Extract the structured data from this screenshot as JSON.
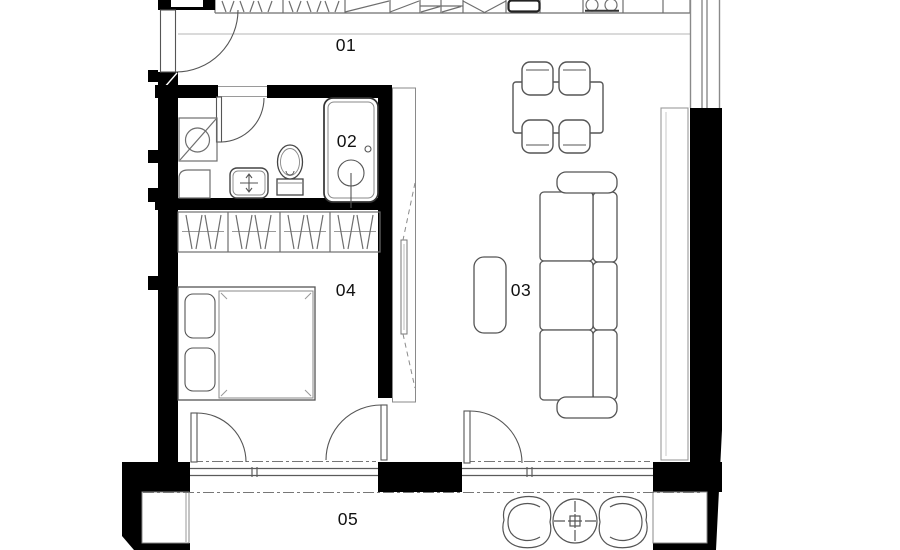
{
  "plan": {
    "title": "apartment-floor-plan",
    "rooms": {
      "r01": {
        "label": "01"
      },
      "r02": {
        "label": "02"
      },
      "r03": {
        "label": "03"
      },
      "r04": {
        "label": "04"
      },
      "r05": {
        "label": "05"
      }
    },
    "colors": {
      "wall": "#000000",
      "furniture_line": "#6e6e6e",
      "fixture_line": "#3c3c3c",
      "label_text": "#111111",
      "background": "#ffffff"
    }
  }
}
